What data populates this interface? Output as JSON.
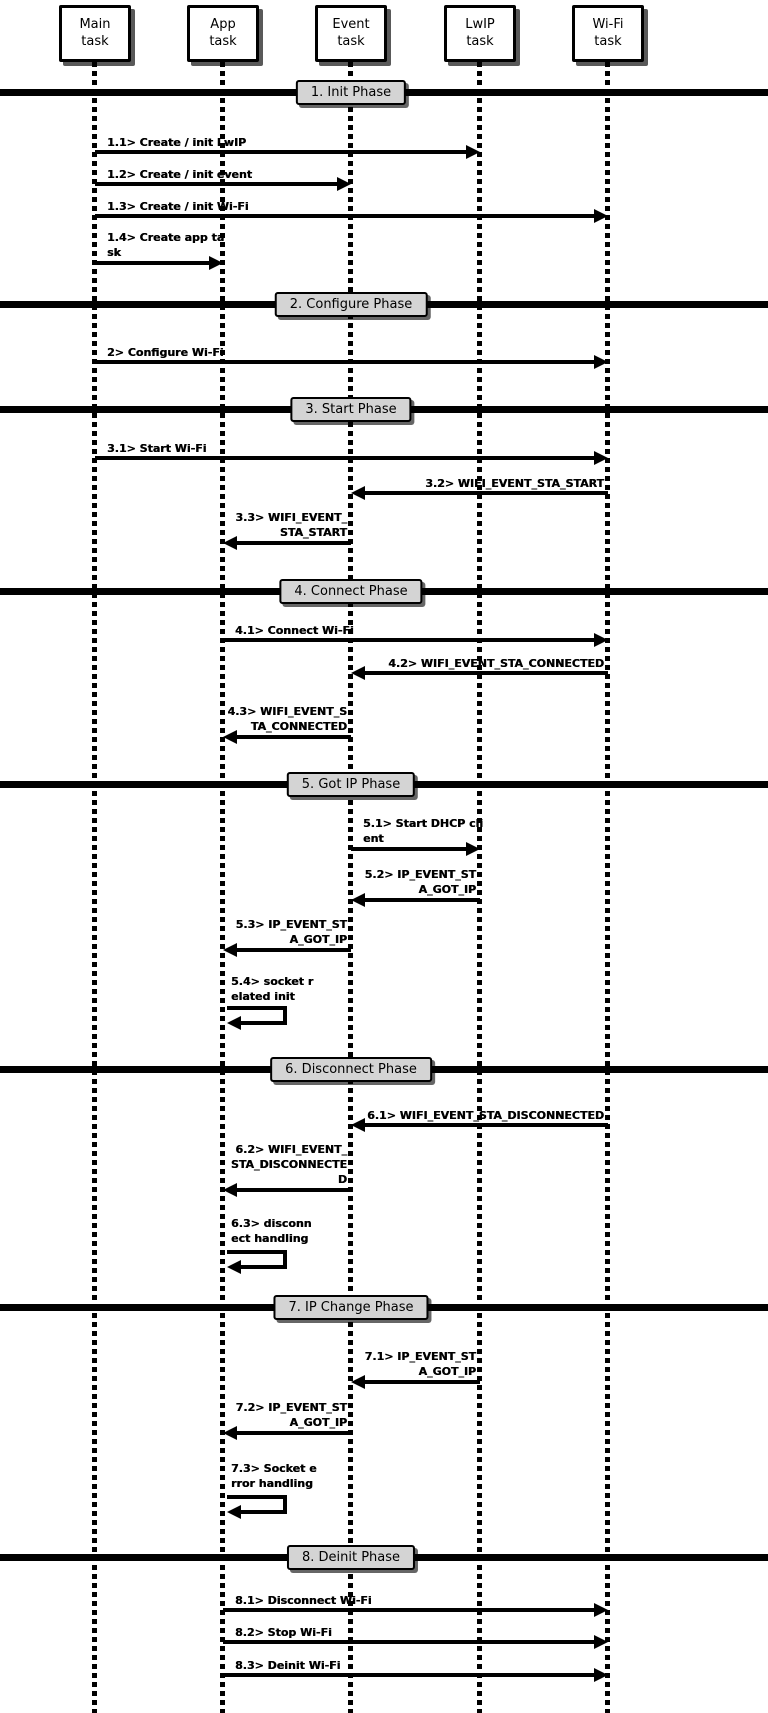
{
  "participants": [
    {
      "label": "Main\ntask"
    },
    {
      "label": "App\ntask"
    },
    {
      "label": "Event\ntask"
    },
    {
      "label": "LwIP\ntask"
    },
    {
      "label": "Wi-Fi\ntask"
    }
  ],
  "phases": [
    {
      "label": "1. Init Phase"
    },
    {
      "label": "2. Configure Phase"
    },
    {
      "label": "3. Start Phase"
    },
    {
      "label": "4. Connect Phase"
    },
    {
      "label": "5. Got IP Phase"
    },
    {
      "label": "6. Disconnect Phase"
    },
    {
      "label": "7. IP Change Phase"
    },
    {
      "label": "8. Deinit Phase"
    }
  ],
  "messages": [
    {
      "id": "1.1",
      "label": "1.1> Create / init LwIP",
      "from": "Main task",
      "to": "LwIP task"
    },
    {
      "id": "1.2",
      "label": "1.2> Create / init event",
      "from": "Main task",
      "to": "Event task"
    },
    {
      "id": "1.3",
      "label": "1.3> Create / init Wi-Fi",
      "from": "Main task",
      "to": "Wi-Fi task"
    },
    {
      "id": "1.4",
      "label": "1.4> Create app ta\nsk",
      "from": "Main task",
      "to": "App task"
    },
    {
      "id": "2",
      "label": "2> Configure Wi-Fi",
      "from": "Main task",
      "to": "Wi-Fi task"
    },
    {
      "id": "3.1",
      "label": "3.1> Start Wi-Fi",
      "from": "Main task",
      "to": "Wi-Fi task"
    },
    {
      "id": "3.2",
      "label": "3.2> WIFI_EVENT_STA_START",
      "from": "Wi-Fi task",
      "to": "Event task"
    },
    {
      "id": "3.3",
      "label": "3.3> WIFI_EVENT_\nSTA_START",
      "from": "Event task",
      "to": "App task"
    },
    {
      "id": "4.1",
      "label": "4.1> Connect Wi-Fi",
      "from": "App task",
      "to": "Wi-Fi task"
    },
    {
      "id": "4.2",
      "label": "4.2> WIFI_EVENT_STA_CONNECTED",
      "from": "Wi-Fi task",
      "to": "Event task"
    },
    {
      "id": "4.3",
      "label": "4.3> WIFI_EVENT_S\nTA_CONNECTED",
      "from": "Event task",
      "to": "App task"
    },
    {
      "id": "5.1",
      "label": "5.1> Start DHCP cli\nent",
      "from": "Event task",
      "to": "LwIP task"
    },
    {
      "id": "5.2",
      "label": "5.2> IP_EVENT_ST\nA_GOT_IP",
      "from": "LwIP task",
      "to": "Event task"
    },
    {
      "id": "5.3",
      "label": "5.3> IP_EVENT_ST\nA_GOT_IP",
      "from": "Event task",
      "to": "App task"
    },
    {
      "id": "5.4",
      "label": "5.4> socket r\nelated init",
      "from": "App task",
      "to": "App task"
    },
    {
      "id": "6.1",
      "label": "6.1> WIFI_EVENT_STA_DISCONNECTED",
      "from": "Wi-Fi task",
      "to": "Event task"
    },
    {
      "id": "6.2",
      "label": "6.2> WIFI_EVENT_\nSTA_DISCONNECTE\nD",
      "from": "Event task",
      "to": "App task"
    },
    {
      "id": "6.3",
      "label": "6.3> disconn\nect handling",
      "from": "App task",
      "to": "App task"
    },
    {
      "id": "7.1",
      "label": "7.1> IP_EVENT_ST\nA_GOT_IP",
      "from": "LwIP task",
      "to": "Event task"
    },
    {
      "id": "7.2",
      "label": "7.2> IP_EVENT_ST\nA_GOT_IP",
      "from": "Event task",
      "to": "App task"
    },
    {
      "id": "7.3",
      "label": "7.3> Socket e\nrror handling",
      "from": "App task",
      "to": "App task"
    },
    {
      "id": "8.1",
      "label": "8.1> Disconnect Wi-Fi",
      "from": "App task",
      "to": "Wi-Fi task"
    },
    {
      "id": "8.2",
      "label": "8.2> Stop Wi-Fi",
      "from": "App task",
      "to": "Wi-Fi task"
    },
    {
      "id": "8.3",
      "label": "8.3> Deinit Wi-Fi",
      "from": "App task",
      "to": "Wi-Fi task"
    }
  ]
}
